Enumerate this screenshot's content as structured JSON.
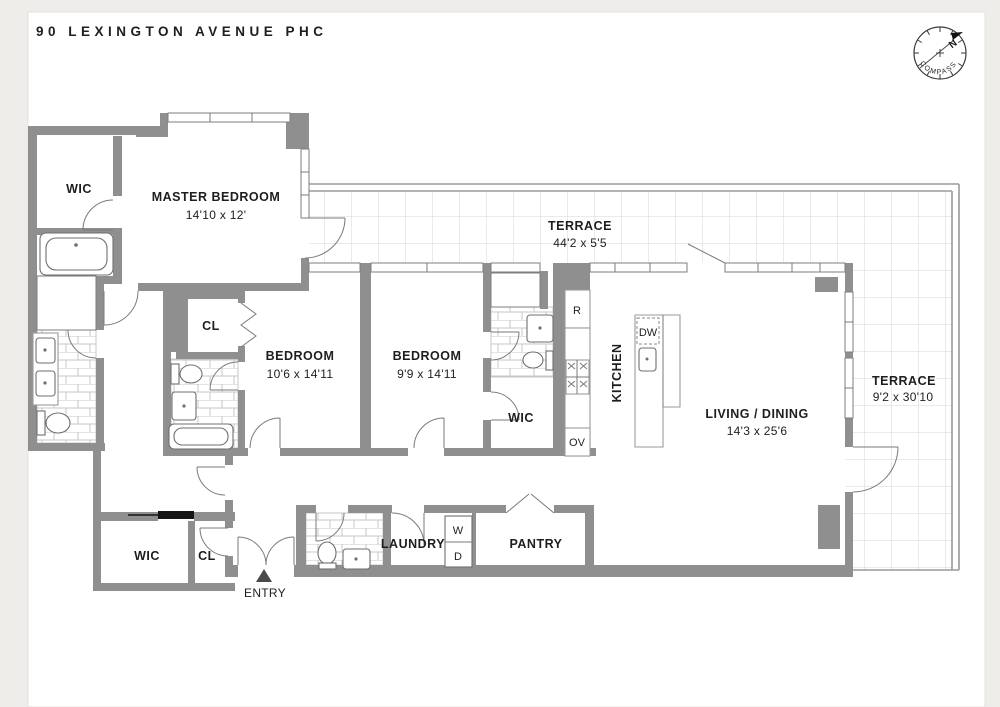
{
  "title": "90 LEXINGTON AVENUE PHC",
  "compass": {
    "label": "COMPASS",
    "north_label": "N"
  },
  "rooms": {
    "wic_master": {
      "name": "WIC"
    },
    "master_bedroom": {
      "name": "MASTER BEDROOM",
      "dims": "14'10 x 12'"
    },
    "terrace_top": {
      "name": "TERRACE",
      "dims": "44'2 x 5'5"
    },
    "closet_bed1": {
      "name": "CL"
    },
    "bedroom1": {
      "name": "BEDROOM",
      "dims": "10'6 x 14'11"
    },
    "bedroom2": {
      "name": "BEDROOM",
      "dims": "9'9 x 14'11"
    },
    "wic_bed2": {
      "name": "WIC"
    },
    "kitchen": {
      "name": "KITCHEN"
    },
    "living_dining": {
      "name": "LIVING / DINING",
      "dims": "14'3 x 25'6"
    },
    "terrace_right": {
      "name": "TERRACE",
      "dims": "9'2 x 30'10"
    },
    "wic_entry": {
      "name": "WIC"
    },
    "closet_entry": {
      "name": "CL"
    },
    "entry": {
      "name": "ENTRY"
    },
    "laundry": {
      "name": "LAUNDRY"
    },
    "pantry": {
      "name": "PANTRY"
    }
  },
  "appliances": {
    "refrigerator": "R",
    "oven": "OV",
    "dishwasher": "DW",
    "washer": "W",
    "dryer": "D"
  },
  "colors": {
    "wall": "#8f8f8f",
    "tile_line": "#c9c7c4",
    "text": "#1e1e1e",
    "north": "#c03434",
    "page": "#f4f3f0"
  }
}
